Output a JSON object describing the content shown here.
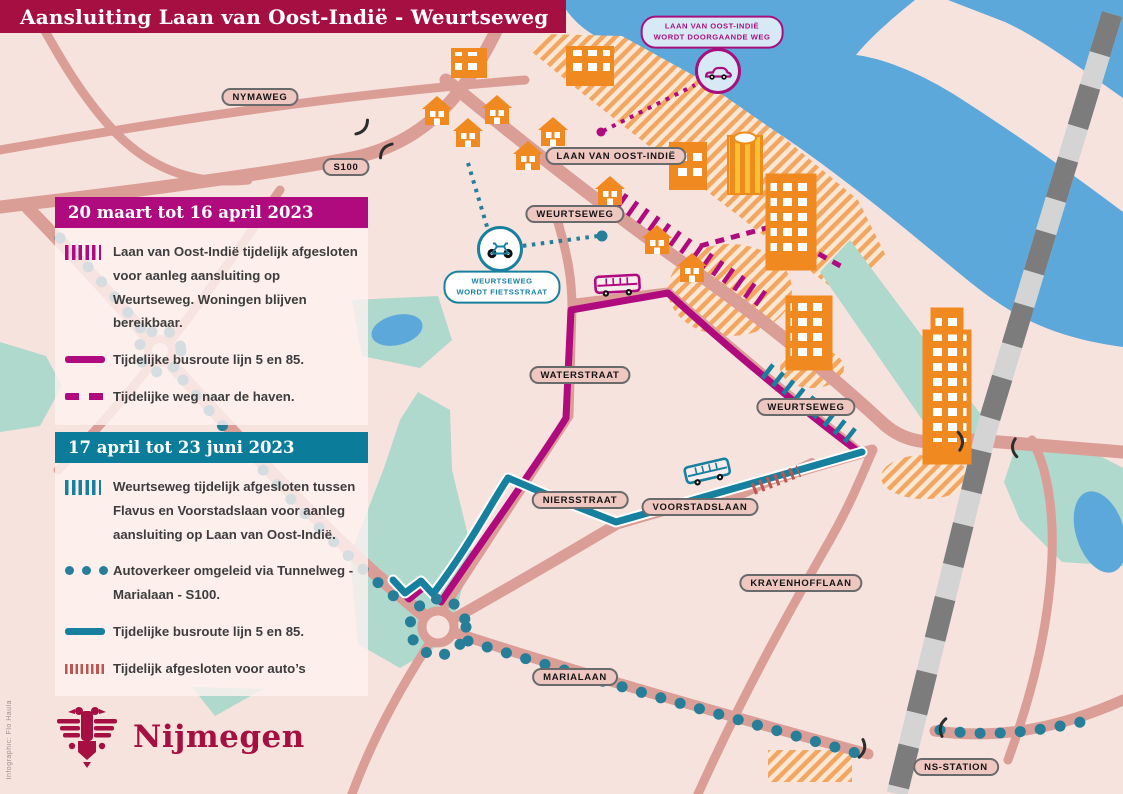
{
  "title": "Aansluiting Laan van Oost-Indië - Weurtseweg",
  "legend_period1": {
    "header": "20 maart tot 16 april 2023",
    "items": [
      {
        "icon": "magenta-closed-hatch-icon",
        "text": "Laan van Oost-Indië tijdelijk afgesloten voor aanleg aansluiting op Weurtseweg. Woningen blijven bereikbaar."
      },
      {
        "icon": "magenta-bus-line-icon",
        "text": "Tijdelijke busroute lijn 5 en 85."
      },
      {
        "icon": "magenta-dashed-line-icon",
        "text": "Tijdelijke weg naar de haven."
      }
    ]
  },
  "legend_period2": {
    "header": "17 april tot 23 juni 2023",
    "items": [
      {
        "icon": "teal-closed-hatch-icon",
        "text": "Weurtseweg tijdelijk afgesloten tussen Flavus en Voorstadslaan voor aanleg aansluiting op Laan van Oost-Indië."
      },
      {
        "icon": "teal-dots-icon",
        "text": "Autoverkeer omgeleid via Tunnelweg - Marialaan - S100."
      },
      {
        "icon": "teal-bus-line-icon",
        "text": "Tijdelijke busroute lijn 5 en 85."
      },
      {
        "icon": "red-car-hatch-icon",
        "text": "Tijdelijk afgesloten voor auto’s"
      }
    ]
  },
  "roads": [
    "NYMAWEG",
    "S100",
    "LAAN VAN OOST-INDIË",
    "WEURTSEWEG",
    "WATERSTRAAT",
    "WEURTSEWEG",
    "NIERSSTRAAT",
    "VOORSTADSLAAN",
    "KRAYENHOFFLAAN",
    "MARIALAAN",
    "NS-STATION"
  ],
  "callouts": {
    "car_line1": "LAAN VAN OOST-INDIË",
    "car_line2": "WORDT DOORGAANDE WEG",
    "bike_line1": "WEURTSEWEG",
    "bike_line2": "WORDT FIETSSTRAAT"
  },
  "logo": {
    "city": "Nijmegen"
  },
  "credit": "Infographic: Flo Haula",
  "colors": {
    "brand_red": "#a50f41",
    "magenta_route": "#b00b7e",
    "teal_route": "#17809f",
    "teal_header": "#0b7d9b",
    "road_salmon": "#db9e96",
    "water_blue": "#5da8db",
    "green_area": "#aed9cc",
    "building_orange": "#f08a20",
    "label_pill_pink": "#efc7c1",
    "closed_for_cars_red": "#bf5550"
  }
}
